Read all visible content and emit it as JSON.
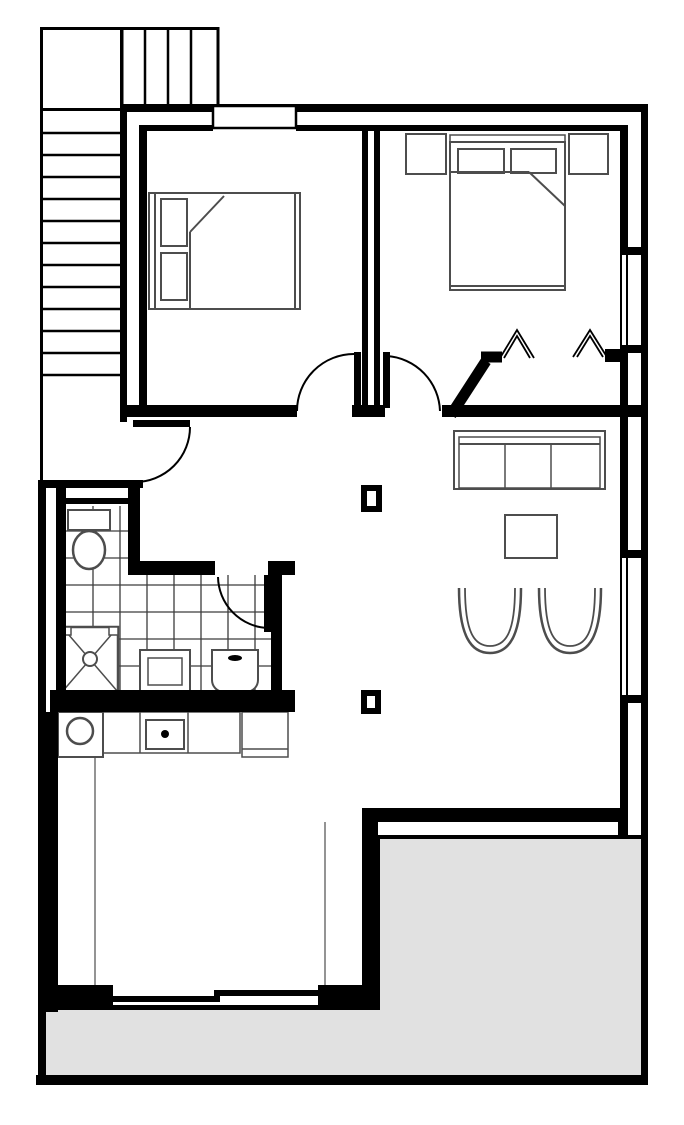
{
  "colors": {
    "background": "#ffffff",
    "wall": "#000000",
    "furniture_stroke": "#4d4d4d",
    "tile_stroke": "#3c3c3c",
    "terrace_fill": "#e1e1e1",
    "fixture_fill": "#ffffff"
  },
  "plan": {
    "type": "residential-floor-plan",
    "rooms": [
      {
        "id": "staircase",
        "elements": [
          "landing",
          "upper-flight-treads",
          "lower-flight-treads"
        ]
      },
      {
        "id": "bedroom-1",
        "elements": [
          "double-bed",
          "two-pillows",
          "folded-blanket",
          "top-window",
          "swing-door"
        ]
      },
      {
        "id": "bedroom-2",
        "elements": [
          "double-bed",
          "two-pillows",
          "two-nightstands",
          "closet-bifold-doors",
          "angled-entry-wall",
          "two-right-windows",
          "swing-door"
        ]
      },
      {
        "id": "bathroom",
        "elements": [
          "toilet",
          "shower-with-drain",
          "washbasin",
          "appliance",
          "tiled-floor",
          "top-window",
          "swing-door"
        ]
      },
      {
        "id": "kitchen-dining",
        "elements": [
          "round-sink",
          "cooktop",
          "counter-run",
          "tall-cabinet",
          "sliding-glass-door"
        ]
      },
      {
        "id": "living-area",
        "elements": [
          "three-seat-sofa",
          "coffee-table",
          "two-tub-chairs",
          "two-structural-columns",
          "hall-swing-door"
        ]
      },
      {
        "id": "terrace",
        "elements": [
          "gray-paved-area"
        ]
      }
    ]
  }
}
